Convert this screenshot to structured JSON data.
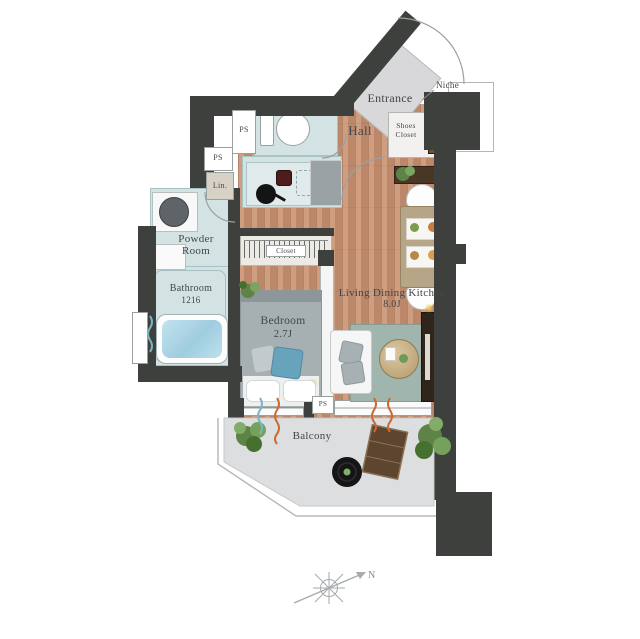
{
  "plan_title": "1K apartment floor plan",
  "labels": {
    "entrance": "Entrance",
    "niche": "Niche",
    "hall": "Hall",
    "shoes_line1": "Shoes",
    "shoes_line2": "Closet",
    "ps": "PS",
    "linen": "Lin.",
    "powder_line1": "Powder",
    "powder_line2": "Room",
    "bathroom_line1": "Bathroom",
    "bathroom_line2": "1216",
    "closet": "Closet",
    "bedroom_line1": "Bedroom",
    "bedroom_line2": "2.7J",
    "ldk_line1": "Living Dining Kitchen",
    "ldk_line2": "8.0J",
    "balcony": "Balcony",
    "north": "N"
  },
  "colors": {
    "wall": "#3d403c",
    "wood_floor": "#c69173",
    "wet_room_floor": "#d3e2e2",
    "entrance_floor": "#d8d8da",
    "balcony_floor": "#dcdedf",
    "curtain_orange": "#cc6a33",
    "curtain_blue": "#79b4c6",
    "rug_green": "#a0b5ad",
    "bed_gray": "#a6b0b2",
    "accent_pillow_blue": "#67a3ba",
    "bath_water": "#9fcde0",
    "tv_board_brown": "#30251a"
  }
}
